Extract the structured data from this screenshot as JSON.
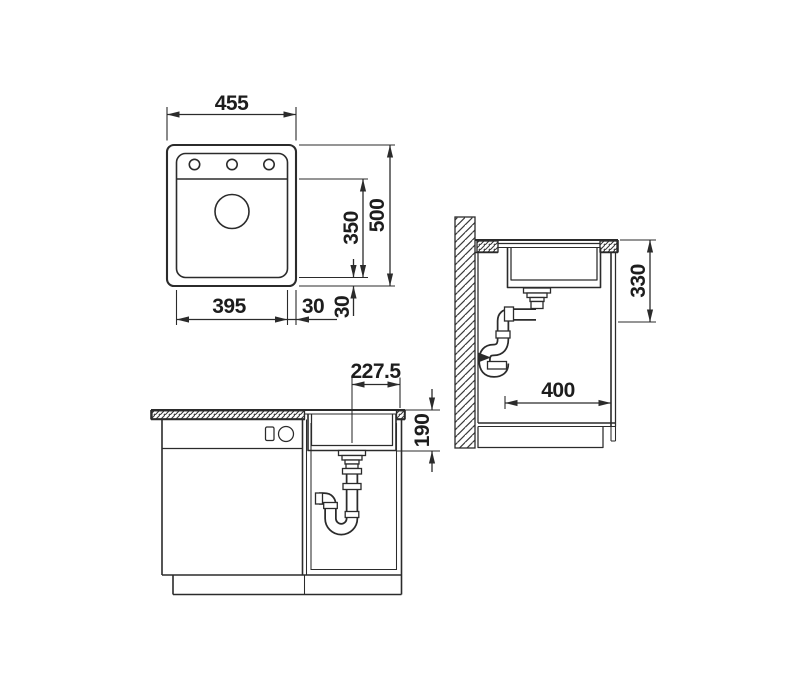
{
  "drawing_title": "Sink installation technical drawing",
  "views": {
    "plan": {
      "name": "top view",
      "dims": {
        "overall_width": "455",
        "overall_depth": "500",
        "bowl_length": "350",
        "bowl_width": "395",
        "right_margin": "30",
        "bottom_margin": "30"
      }
    },
    "side": {
      "name": "side section",
      "dims": {
        "required_depth": "330",
        "cabinet_clearance": "400"
      }
    },
    "front": {
      "name": "front section",
      "dims": {
        "drain_center_offset": "227.5",
        "bowl_depth": "190"
      }
    }
  },
  "colors": {
    "line": "#2b2b2b",
    "text": "#1d1d1d",
    "background": "#ffffff"
  }
}
